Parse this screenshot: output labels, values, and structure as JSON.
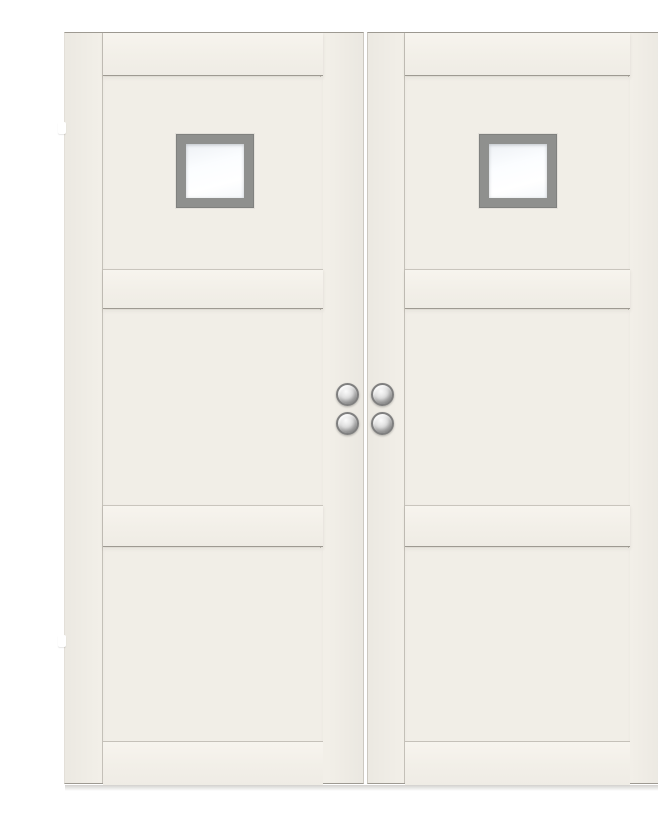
{
  "scene": {
    "kind": "product photograph",
    "subject": "Pair of white 3-panel interior double doors, each with a small square glass window and round chrome knobs at the meeting stiles",
    "door_leaf_count": 2,
    "panels_per_leaf": 3,
    "window_count": 2,
    "knob_count": 4,
    "hinge_count": 4,
    "text_content": ""
  },
  "colors": {
    "background": "#ffffff",
    "door_face": "#f2efe8",
    "door_face_light": "#f7f4ee",
    "panel_face": "#f1eee7",
    "edge_line_dark": "#9e9a92",
    "rail_shadow": "rgba(90,85,75,0.14)",
    "window_frame": "#8f908e",
    "glass": "#fbfdff",
    "hinge": "#ffffff",
    "knob_ring": "#7f7f7f",
    "knob_light": "#fbfbfb",
    "knob_mid": "#dedede",
    "knob_dark": "#a8a8a8",
    "floor_shadow": "rgba(115,110,100,0.32)"
  }
}
